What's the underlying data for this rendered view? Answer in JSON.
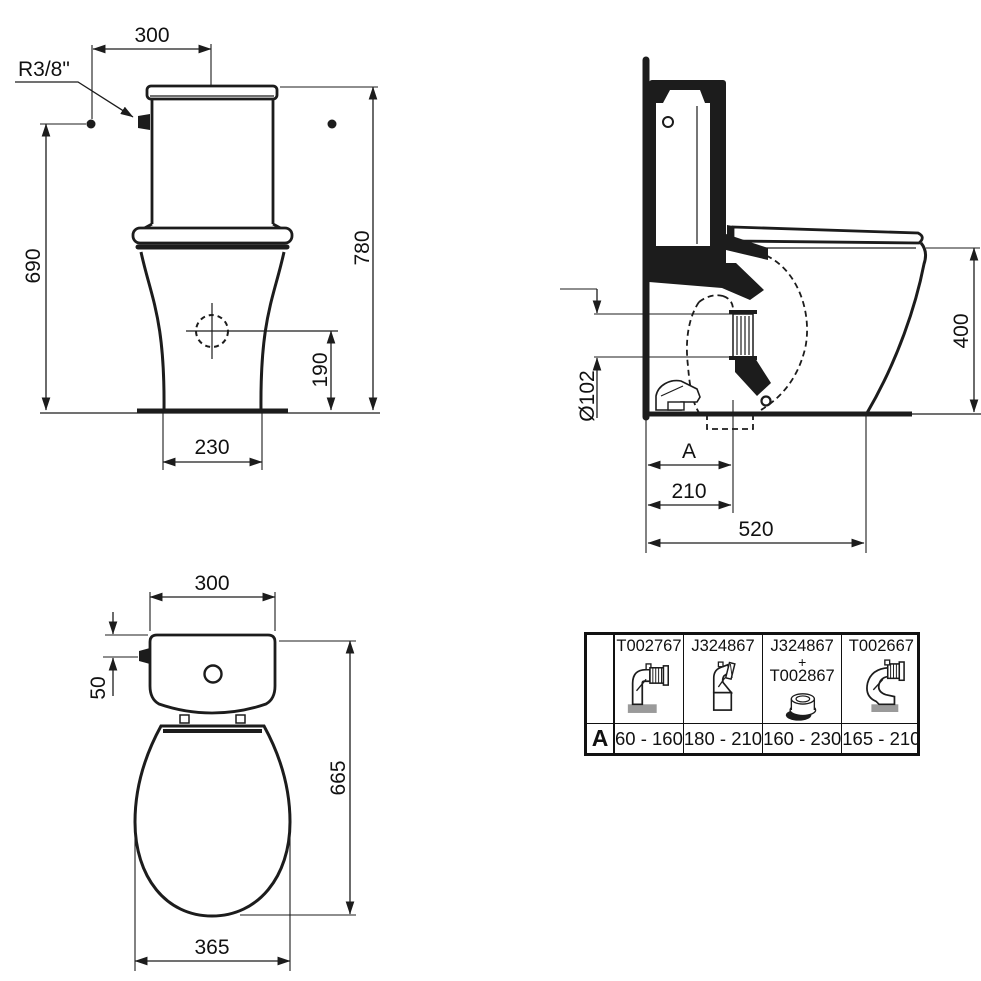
{
  "drawing": {
    "front_view": {
      "top_width": "300",
      "inlet_thread": "R3/8\"",
      "inlet_height": "690",
      "total_height": "780",
      "outlet_center_height": "190",
      "base_width": "230"
    },
    "side_view": {
      "seat_height": "400",
      "outlet_diameter": "Ø102",
      "adjustable_dim": "A",
      "outlet_wall_distance": "210",
      "depth": "520"
    },
    "top_view": {
      "tank_width": "300",
      "inlet_offset": "50",
      "total_length": "665",
      "bowl_width": "365"
    }
  },
  "compatibility_table": {
    "row_label": "A",
    "columns": [
      {
        "part": "T002767",
        "range": "60 - 160",
        "icon": "elbow-corrugated-pipe-icon"
      },
      {
        "part": "J324867",
        "range": "180 - 210",
        "icon": "offset-bend-pipe-icon"
      },
      {
        "part": "J324867",
        "plus": "+",
        "part2": "T002867",
        "range": "160 - 230",
        "icon": "eccentric-seal-icon"
      },
      {
        "part": "T002667",
        "range": "165 - 210",
        "icon": "flexible-elbow-pipe-icon"
      }
    ]
  },
  "colors": {
    "line": "#1c1c1c",
    "background": "#ffffff",
    "icon_base_gray": "#9a9a9a"
  }
}
